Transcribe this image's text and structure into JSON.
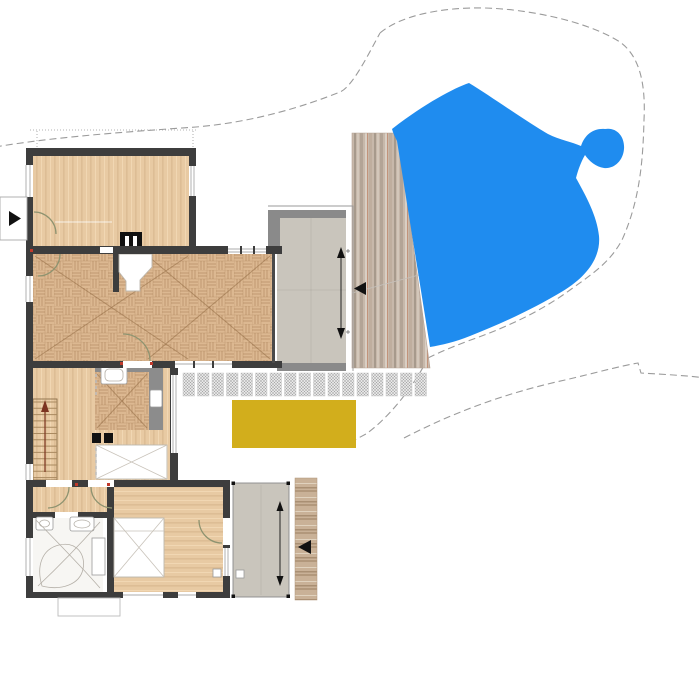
{
  "palette": {
    "wall": "#3d3d3d",
    "gray_wall": "#8c8c8c",
    "wood_base": "#e8caa3",
    "parquet_base": "#dcb891",
    "terrace_floor": "#c9c5bc",
    "terrace_band": "#8a8a8a",
    "pool_blue": "#1f8cef",
    "deck_yellow": "#d2ae1c",
    "contour_gray": "#9b9b9b",
    "door_arc": "#8e9370",
    "stair_arrow": "#7c3420",
    "accent_red": "#c0392b",
    "stone_base": "#c7b8aa",
    "plank_base": "#c9b197"
  },
  "site": {
    "pool": {
      "path": "M392,129 C424,104 454,88 469,83 C492,97 524,120 548,134 C560,140 572,142 581,146 C585,134 594,128 605,129 C617,127 625,137 624,149 C623,161 614,169 604,168 C596,167 589,161 585,155 C581,162 578,170 576,178 C586,196 597,216 599,236 C601,258 586,277 563,291 C535,308 505,322 470,336 C455,342 442,345 430,347 L397,141 C395,137 393,133 392,129 Z"
    },
    "stone_band": {
      "points": "352,133 398,133 430,368 352,368"
    },
    "yellow_deck": {
      "x": 232,
      "y": 400,
      "w": 124,
      "h": 48
    },
    "pavers": {
      "x0": 183,
      "y": 373,
      "tile_w": 11.5,
      "tile_h": 23,
      "pitch": 14.5,
      "count": 17
    },
    "contours": {
      "c1": "M-5,147 C60,136 140,131 196,127 C255,122 305,106 340,92 C352,87 367,57 380,33",
      "c2": "M380,33 C400,16 440,7 485,8 C525,9 585,20 620,42 C638,55 646,80 644,120 C643,160 640,200 622,240 C610,262 595,272 570,290 C540,312 505,328 468,341 C452,347 440,352 428,358",
      "c4a": "M428,358 C412,390 386,420 366,434 L349,443",
      "c4b": "M404,438 C462,408 515,391 565,380 C595,373 620,366 638,363 L641,373 L658,374 C674,375 690,376 706,378",
      "c3": "M352,293 L430,272"
    },
    "roofline": {
      "d": "M30,130 L196,130 M37,131 L37,148 M193,131 L193,148"
    }
  },
  "bath": {
    "tub_path": "M42,586 C36,566 42,549 59,545 C77,541 86,555 83,569 C80,584 62,591 42,586 Z",
    "curve1": "M36,520 C60,545 80,565 100,588",
    "curve2": "M100,522 C75,550 55,570 38,586"
  },
  "hearth": {
    "points": "119,254 152,254 152,267 140,280 140,291 126,291 126,281 119,272"
  },
  "stairs": {
    "x": 33,
    "width": 24,
    "y_top": 402,
    "tread_pitch": 6.3,
    "tread_count": 13
  },
  "annotations": {
    "entry_arrow_dir": "right",
    "stone_band_marker_dir": "left",
    "plank_marker_dir": "left",
    "stair_arrow_dir": "up",
    "upper_terrace_arrow": "double-vertical",
    "lower_terrace_arrow": "double-vertical"
  }
}
